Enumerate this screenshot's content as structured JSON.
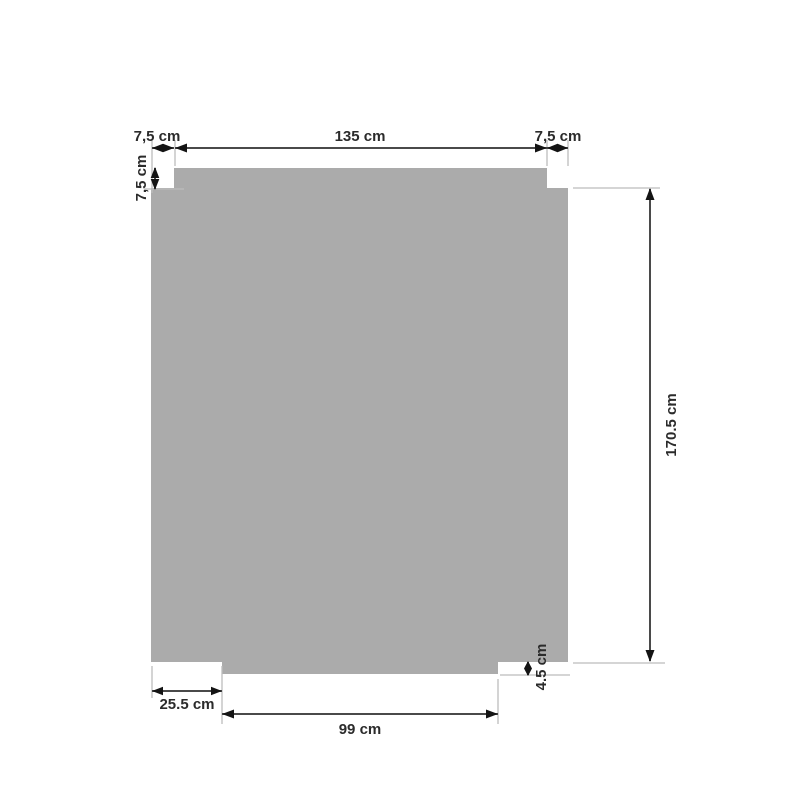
{
  "diagram": {
    "name": "fitted-panel-dimension-drawing",
    "unit": "cm",
    "colors": {
      "background": "#ffffff",
      "shape_fill": "#ababab",
      "dimension_line": "#4a4a4a",
      "extension_line": "#bcbcbc",
      "arrow": "#141414",
      "text": "#2b2b2b"
    },
    "labels": {
      "top_left_width": "7,5 cm",
      "top_width": "135 cm",
      "top_right_width": "7,5 cm",
      "left_notch_depth": "7,5 cm",
      "right_height": "170.5 cm",
      "bottom_left_width": "25.5 cm",
      "bottom_center_width": "99 cm",
      "bottom_right_notch_depth": "4.5 cm"
    },
    "measurements": {
      "top_left_width_cm": 7.5,
      "top_width_cm": 135,
      "top_right_width_cm": 7.5,
      "left_notch_depth_cm": 7.5,
      "right_height_cm": 170.5,
      "bottom_left_width_cm": 25.5,
      "bottom_center_width_cm": 99,
      "bottom_right_notch_depth_cm": 4.5
    }
  }
}
